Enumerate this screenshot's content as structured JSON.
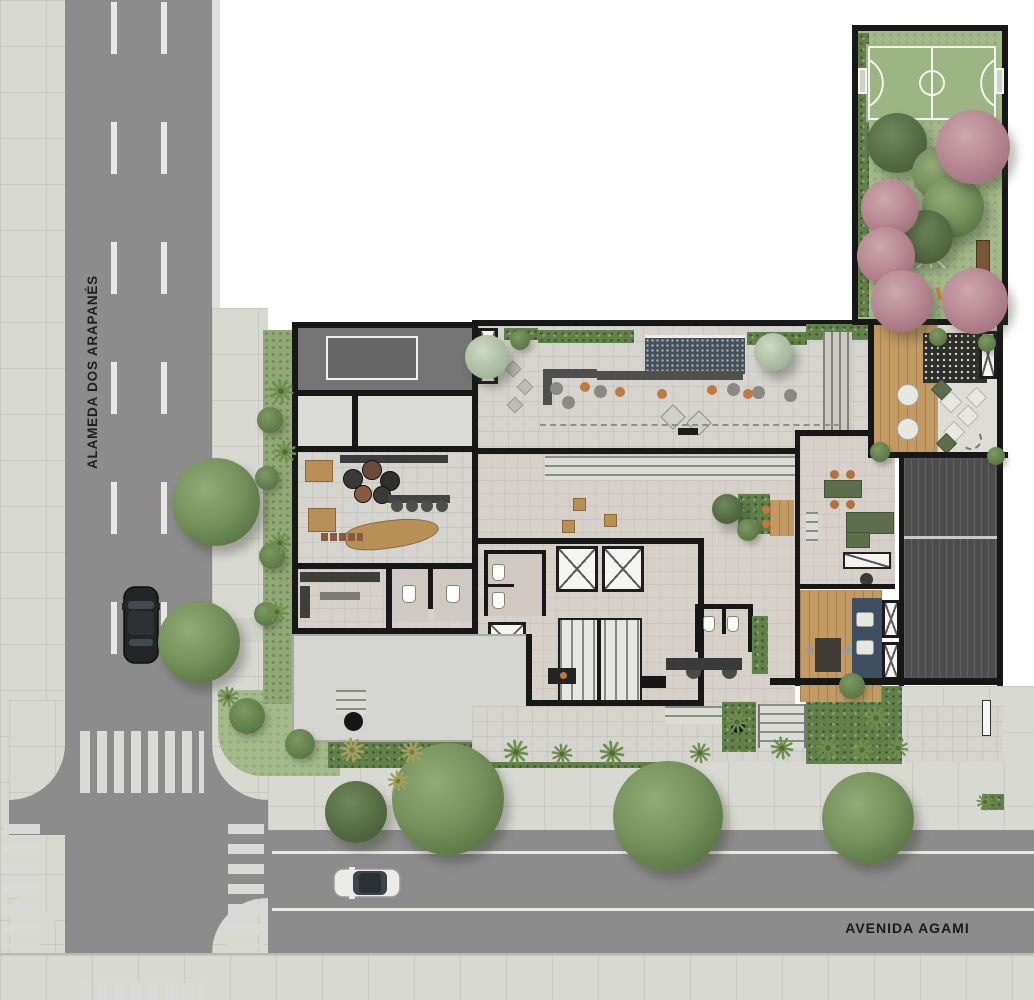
{
  "title": "Residential ground-floor site plan",
  "streets": {
    "left": {
      "name": "ALAMEDA DOS ARAPANÉS"
    },
    "bottom": {
      "name": "AVENIDA AGAMI"
    }
  },
  "colors": {
    "road": "#8c8c8c",
    "sidewalk": "#d9d9d4",
    "lane_marking": "#e8e8e5",
    "crosswalk": "#dadad8",
    "wall": "#171717",
    "grass": "#a4ba8b",
    "court_surface": "#9cb583",
    "court_line": "#f3f5ef",
    "hedge": "#61804a",
    "stone_floor": "#d5d4cf",
    "interior_floor": "#d7d1cc",
    "wood": "#c39a62",
    "dark_room": "#747474",
    "garage_ramp": "#4d4d4d",
    "water_feature": "#46505b",
    "accent_orange": "#c07a3e",
    "furniture_green": "#5d6f4a",
    "furniture_blue": "#3e4f63",
    "tree_green": "#74905b",
    "tree_pink": "#b2838f"
  },
  "sport_court": {
    "type": "futsal-court",
    "surface": "#9cb583",
    "line_color": "#f3f5ef"
  },
  "vehicles": [
    {
      "kind": "suv",
      "body_color": "#232526",
      "street": "left",
      "heading": "north"
    },
    {
      "kind": "sedan",
      "body_color": "#ebebe9",
      "street": "bottom",
      "heading": "west"
    }
  ],
  "landscape": {
    "trees": [
      {
        "x": 216,
        "y": 502,
        "r": 44,
        "type": "green"
      },
      {
        "x": 199,
        "y": 642,
        "r": 41,
        "type": "green"
      },
      {
        "x": 356,
        "y": 812,
        "r": 31,
        "type": "dark"
      },
      {
        "x": 448,
        "y": 799,
        "r": 56,
        "type": "green"
      },
      {
        "x": 668,
        "y": 816,
        "r": 55,
        "type": "green"
      },
      {
        "x": 868,
        "y": 818,
        "r": 46,
        "type": "green"
      },
      {
        "x": 897,
        "y": 143,
        "r": 30,
        "type": "dark"
      },
      {
        "x": 938,
        "y": 173,
        "r": 26,
        "type": "green"
      },
      {
        "x": 953,
        "y": 207,
        "r": 31,
        "type": "green"
      },
      {
        "x": 926,
        "y": 237,
        "r": 27,
        "type": "dark"
      },
      {
        "x": 973,
        "y": 147,
        "r": 37,
        "type": "pink"
      },
      {
        "x": 890,
        "y": 208,
        "r": 29,
        "type": "pink"
      },
      {
        "x": 886,
        "y": 256,
        "r": 29,
        "type": "pink"
      },
      {
        "x": 902,
        "y": 301,
        "r": 31,
        "type": "pink"
      },
      {
        "x": 975,
        "y": 301,
        "r": 33,
        "type": "pink"
      },
      {
        "x": 487,
        "y": 357,
        "r": 22,
        "type": "pale"
      },
      {
        "x": 773,
        "y": 352,
        "r": 19,
        "type": "pale"
      },
      {
        "x": 727,
        "y": 509,
        "r": 15,
        "type": "dark"
      },
      {
        "x": 270,
        "y": 420,
        "r": 13,
        "type": "bush"
      },
      {
        "x": 267,
        "y": 478,
        "r": 12,
        "type": "bush"
      },
      {
        "x": 272,
        "y": 556,
        "r": 13,
        "type": "bush"
      },
      {
        "x": 266,
        "y": 614,
        "r": 12,
        "type": "bush"
      },
      {
        "x": 247,
        "y": 716,
        "r": 18,
        "type": "bush"
      },
      {
        "x": 300,
        "y": 744,
        "r": 15,
        "type": "bush"
      },
      {
        "x": 852,
        "y": 686,
        "r": 13,
        "type": "bush"
      },
      {
        "x": 938,
        "y": 337,
        "r": 9,
        "type": "bush"
      },
      {
        "x": 987,
        "y": 343,
        "r": 9,
        "type": "bush"
      },
      {
        "x": 880,
        "y": 452,
        "r": 10,
        "type": "bush"
      },
      {
        "x": 996,
        "y": 456,
        "r": 9,
        "type": "bush"
      },
      {
        "x": 748,
        "y": 530,
        "r": 11,
        "type": "bush"
      },
      {
        "x": 520,
        "y": 340,
        "r": 10,
        "type": "bush"
      }
    ],
    "palms": [
      {
        "x": 281,
        "y": 391,
        "s": 13,
        "tone": "green"
      },
      {
        "x": 285,
        "y": 452,
        "s": 12,
        "tone": "green"
      },
      {
        "x": 280,
        "y": 543,
        "s": 12,
        "tone": "green"
      },
      {
        "x": 277,
        "y": 612,
        "s": 11,
        "tone": "green"
      },
      {
        "x": 228,
        "y": 697,
        "s": 11,
        "tone": "green"
      },
      {
        "x": 352,
        "y": 750,
        "s": 13,
        "tone": "gold"
      },
      {
        "x": 412,
        "y": 752,
        "s": 12,
        "tone": "gold"
      },
      {
        "x": 516,
        "y": 752,
        "s": 13,
        "tone": "green"
      },
      {
        "x": 562,
        "y": 754,
        "s": 11,
        "tone": "green"
      },
      {
        "x": 612,
        "y": 753,
        "s": 13,
        "tone": "green"
      },
      {
        "x": 700,
        "y": 753,
        "s": 11,
        "tone": "green"
      },
      {
        "x": 782,
        "y": 748,
        "s": 12,
        "tone": "green"
      },
      {
        "x": 828,
        "y": 748,
        "s": 13,
        "tone": "green"
      },
      {
        "x": 862,
        "y": 750,
        "s": 12,
        "tone": "green"
      },
      {
        "x": 876,
        "y": 718,
        "s": 13,
        "tone": "green"
      },
      {
        "x": 898,
        "y": 748,
        "s": 11,
        "tone": "green"
      },
      {
        "x": 737,
        "y": 722,
        "s": 12,
        "tone": "green"
      },
      {
        "x": 398,
        "y": 781,
        "s": 11,
        "tone": "gold"
      },
      {
        "x": 985,
        "y": 802,
        "s": 9,
        "tone": "green"
      }
    ]
  }
}
